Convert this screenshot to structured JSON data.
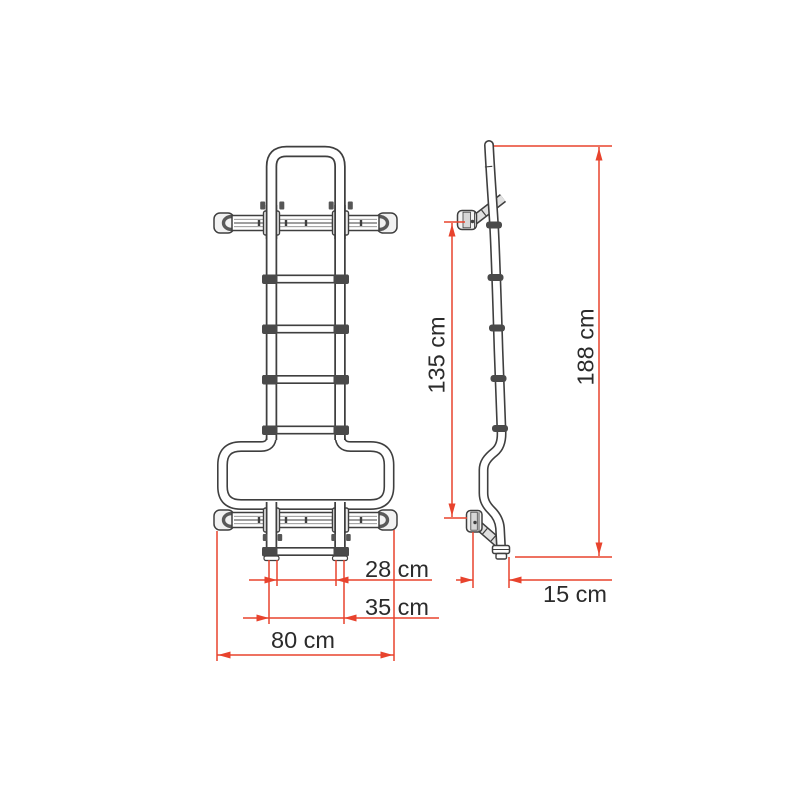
{
  "drawing": {
    "front_view": {
      "inner_width_label": "28 cm",
      "step_width_label": "35 cm",
      "total_width_label": "80 cm"
    },
    "side_view": {
      "mount_height_label": "135 cm",
      "total_height_label": "188 cm",
      "depth_label": "15 cm"
    },
    "colors": {
      "dimension_accent": "#e8432d",
      "line_art": "#3f3f3f",
      "label_text": "#2b2b2b",
      "background": "#ffffff"
    }
  }
}
